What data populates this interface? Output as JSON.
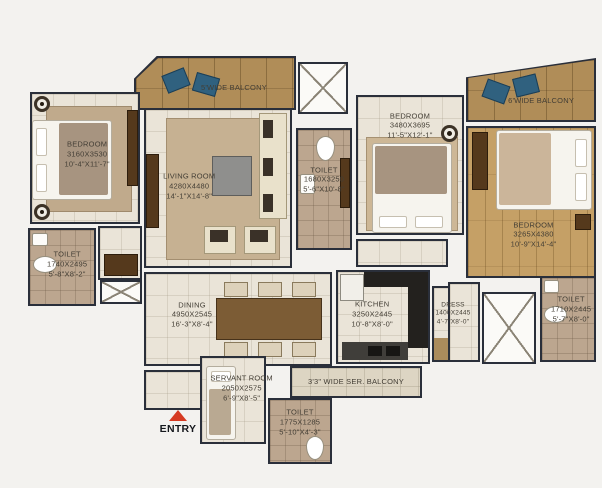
{
  "plan": {
    "entry_label": "ENTRY",
    "rooms": {
      "bedroom_top_left": {
        "name": "BEDROOM",
        "dims_mm": "3160X3530",
        "dims_ft": "10'-4\"X11'-7\""
      },
      "living_room": {
        "name": "LIVING ROOM",
        "dims_mm": "4280X4480",
        "dims_ft": "14'-1\"X14'-8\""
      },
      "balcony_top": {
        "name": "5'WIDE BALCONY"
      },
      "toilet_center": {
        "name": "TOILET",
        "dims_mm": "1680X3250",
        "dims_ft": "5'-6\"X10'-8\""
      },
      "bedroom_center": {
        "name": "BEDROOM",
        "dims_mm": "3480X3695",
        "dims_ft": "11'-5\"X12'-1\""
      },
      "balcony_right": {
        "name": "6'WIDE BALCONY"
      },
      "bedroom_master": {
        "name": "BEDROOM",
        "dims_mm": "3265X4380",
        "dims_ft": "10'-9\"X14'-4\""
      },
      "toilet_left": {
        "name": "TOILET",
        "dims_mm": "1740X2495",
        "dims_ft": "5'-8\"X8'-2\""
      },
      "dining": {
        "name": "DINING",
        "dims_mm": "4950X2545",
        "dims_ft": "16'-3\"X8'-4\""
      },
      "kitchen": {
        "name": "KITCHEN",
        "dims_mm": "3250X2445",
        "dims_ft": "10'-8\"X8'-0\""
      },
      "dress": {
        "name": "DRESS",
        "dims_mm": "1400X2445",
        "dims_ft": "4'-7\"X8'-0\""
      },
      "toilet_right": {
        "name": "TOILET",
        "dims_mm": "1710X2445",
        "dims_ft": "5'-7\"X8'-0\""
      },
      "servant_room": {
        "name": "SERVANT ROOM",
        "dims_mm": "2050X2575",
        "dims_ft": "6'-9\"X8'-5\""
      },
      "toilet_bottom": {
        "name": "TOILET",
        "dims_mm": "1775X1285",
        "dims_ft": "5'-10\"X4'-3\""
      },
      "service_balcony": {
        "name": "3'3\" WIDE SER. BALCONY"
      }
    },
    "colors": {
      "wall_line": "#2a2f3a",
      "tile_floor": "#eae4d8",
      "toilet_floor": "#bca68f",
      "balcony_wood": "#b08d58",
      "bedroom_wood": "#c5a066",
      "accent_chair_blue": "#30617f",
      "entry_red": "#d63b22"
    }
  }
}
